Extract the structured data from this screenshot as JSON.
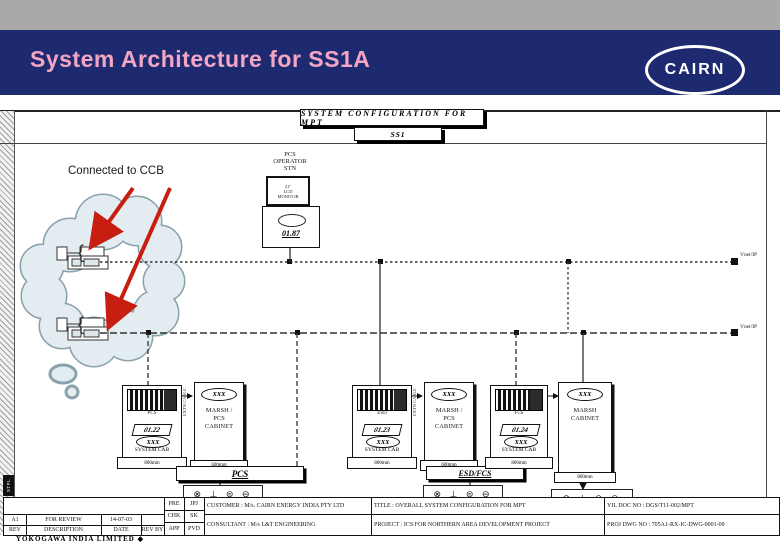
{
  "header": {
    "title": "System Architecture for SS1A",
    "logo": "CAIRN",
    "accent_pink": "#f2a6c4",
    "navy": "#1e2a70",
    "gray_bar": "#a9a9a9"
  },
  "drawing": {
    "sheet_title": "SYSTEM CONFIGURATION FOR MPT",
    "sheet_tag": "SS1",
    "cloud_note": "Connected to CCB",
    "arrow_color": "#c81d11",
    "operator": {
      "l1": "PCS",
      "l2": "OPERATOR",
      "l3": "STN",
      "mon1": "21\"",
      "mon2": "LCD",
      "mon3": "MONITOR",
      "tag": "01.87"
    },
    "bus1_label": "Vnet/IP",
    "bus2_label": "Vnet/IP",
    "symbols": "⊗ ⊥ ⊜ ⊖",
    "cable_note": "EXTN CABLE",
    "groups": [
      {
        "rack_caption": "PCS",
        "tag": "01.22",
        "oval": "XXX",
        "caption": "SYSTEM CAB",
        "width": "800mm",
        "cab_oval": "XXX",
        "cab_l1": "MARSH /",
        "cab_l2": "PCS",
        "cab_l3": "CABINET",
        "cab_width": "600mm",
        "bar": "PCS"
      },
      {
        "rack_caption": "ESD",
        "tag": "01.23",
        "oval": "XXX",
        "caption": "SYSTEM CAB",
        "width": "800mm",
        "cab_oval": "XXX",
        "cab_l1": "MARSH /",
        "cab_l2": "PCS",
        "cab_l3": "CABINET",
        "cab_width": "600mm",
        "bar": "ESD/FCS"
      },
      {
        "rack_caption": "FCS",
        "tag": "01.24",
        "oval": "XXX",
        "caption": "SYSTEM CAB",
        "width": "800mm"
      }
    ],
    "right_cab": {
      "oval": "XXX",
      "l1": "MARSH",
      "l2": "CABINET",
      "width": "800mm"
    }
  },
  "titleblock": {
    "rev": "A1",
    "rev_desc": "FOR REVIEW",
    "rev_date": "14-07-03",
    "col_rev": "REV",
    "col_desc": "DESCRIPTION",
    "col_date": "DATE",
    "col_revby": "REV BY",
    "pre": "PRE",
    "pre_v": "JPJ",
    "chk": "CHK",
    "chk_v": "SK",
    "app": "APP",
    "app_v": "PVD",
    "customer_label": "CUSTOMER :",
    "customer": "M/s. CAIRN ENERGY INDIA PTY LTD",
    "consultant_label": "CONSULTANT :",
    "consultant": "M/s  L&T ENGINEERING",
    "title_label": "TITLE :",
    "title": "OVERALL SYSTEM CONFIGURATION FOR MPT",
    "project_label": "PROJECT :",
    "project": "ICS FOR NORTHERN AREA DEVELOPMENT PROJECT",
    "yil_doc": "YIL DOC NO : DGS/T11-002/MPT",
    "proj_dwg": "PROJ DWG NO : 705A1-RX-IC-DWG-0001-09",
    "margin_tag": "STPL",
    "footer": "YOKOGAWA INDIA LIMITED ◆"
  }
}
